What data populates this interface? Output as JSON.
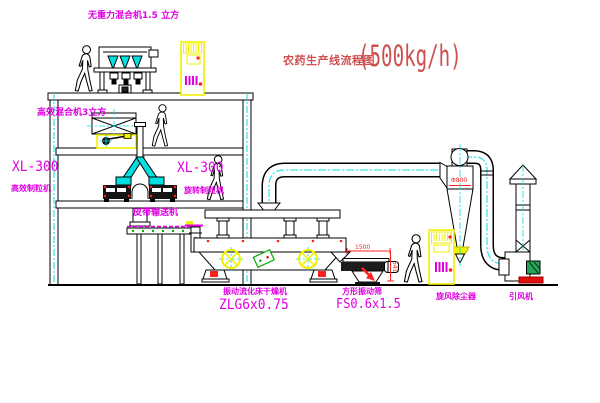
{
  "title": {
    "name": "农药生产线流程图",
    "capacity": "(500kg/h)"
  },
  "equipment": {
    "gravity_free_mixer": {
      "label": "无重力混合机1.5 立方"
    },
    "high_efficiency_mixer": {
      "label": "高效混合机3立方"
    },
    "granulator_left": {
      "model": "XL-300",
      "name": "高效制粒机"
    },
    "granulator_center": {
      "model": "XL-300",
      "name": "旋转制粒机"
    },
    "belt_conveyor": {
      "name": "皮带输送机"
    },
    "fluid_bed_dryer": {
      "name": "振动流化床干燥机",
      "model": "ZLG6x0.75"
    },
    "vibrating_sieve": {
      "name": "方形振动筛",
      "model": "FS0.6x1.5"
    },
    "cyclone": {
      "name": "旋风除尘器",
      "diameter": "Φ800"
    },
    "induced_draft_fan": {
      "name": "引风机"
    }
  },
  "dimensions": {
    "sieve_length": "1500",
    "sieve_height": "541",
    "cyclone_diameter": "Φ800"
  },
  "colors": {
    "label_magenta": "#e000e0",
    "title_red": "#cd4f4f",
    "dimension_red": "#ff2020",
    "centerline_cyan": "#00e0e0",
    "cabinet_yellow": "#f0f000"
  }
}
